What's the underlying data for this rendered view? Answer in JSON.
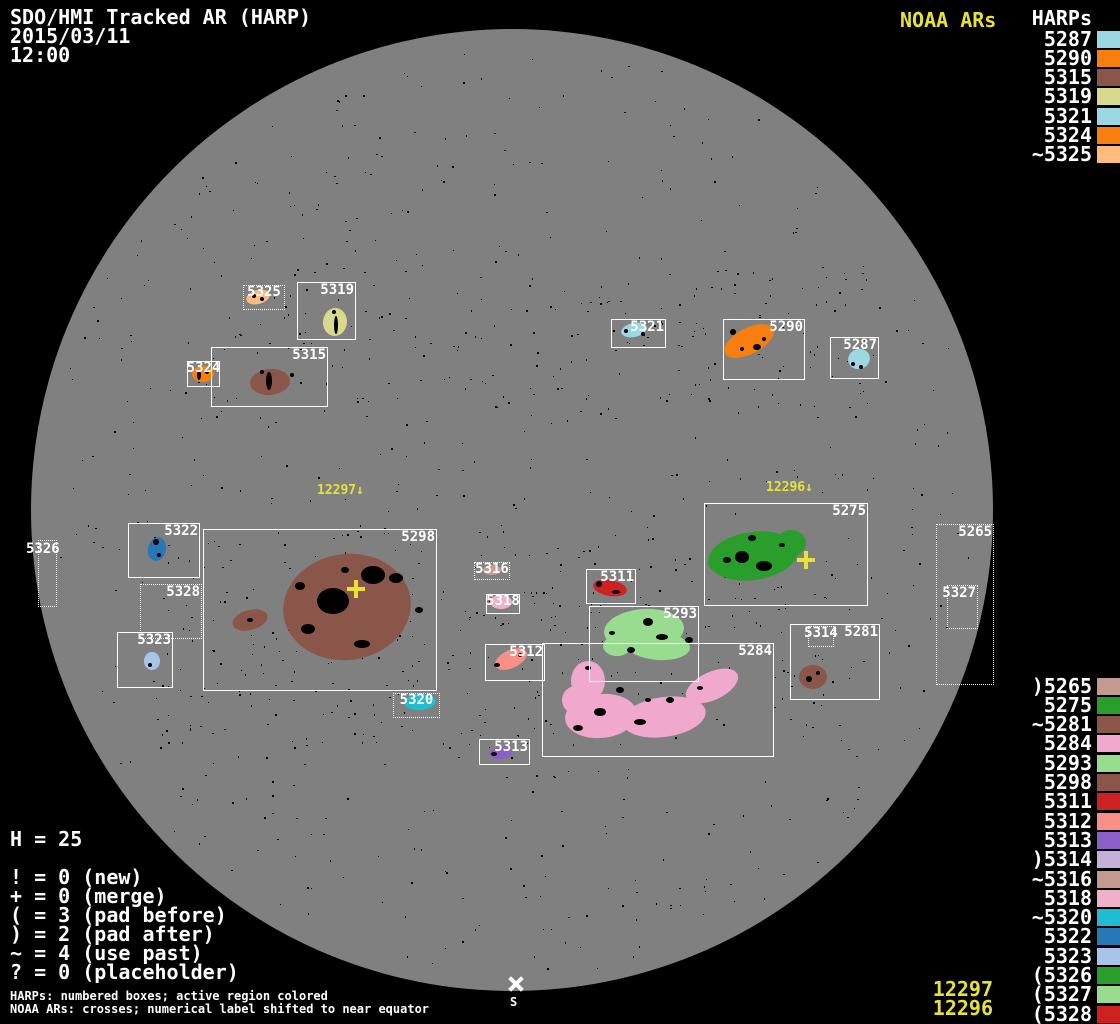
{
  "header": {
    "title": "SDO/HMI Tracked AR (HARP)",
    "date": "2015/03/11",
    "time": "12:00",
    "noaa_header": "NOAA ARs",
    "harps_header": "HARPs"
  },
  "colors": {
    "background": "#000000",
    "disk": "#808080",
    "box_border": "#ffffff",
    "label_white": "#ffffff",
    "noaa_yellow": "#e8e332",
    "speck": "#000000"
  },
  "disk": {
    "cx": 512,
    "cy": 510,
    "r": 481
  },
  "harp_list_top": [
    {
      "label": "5287",
      "color": "#9cd8e4"
    },
    {
      "label": "5290",
      "color": "#f87e10"
    },
    {
      "label": "5315",
      "color": "#8b564a"
    },
    {
      "label": "5319",
      "color": "#d8d88e"
    },
    {
      "label": "5321",
      "color": "#9cd8e4"
    },
    {
      "label": "5324",
      "color": "#f87e10"
    },
    {
      "label": "~5325",
      "color": "#ffbc7c"
    }
  ],
  "harp_list_bottom": [
    {
      "label": ")5265",
      "color": "#c49a90"
    },
    {
      "label": "5275",
      "color": "#2a9e2a"
    },
    {
      "label": "~5281",
      "color": "#8b564a"
    },
    {
      "label": "5284",
      "color": "#f0a8cc"
    },
    {
      "label": "5293",
      "color": "#98dc90"
    },
    {
      "label": "5298",
      "color": "#8b564a"
    },
    {
      "label": "5311",
      "color": "#cc2222"
    },
    {
      "label": "5312",
      "color": "#f89088"
    },
    {
      "label": "5313",
      "color": "#8a5fc8"
    },
    {
      "label": ")5314",
      "color": "#c4b0d8"
    },
    {
      "label": "~5316",
      "color": "#c49a90"
    },
    {
      "label": "5318",
      "color": "#f0b0c8"
    },
    {
      "label": "~5320",
      "color": "#20bcd0"
    },
    {
      "label": "5322",
      "color": "#2878b8"
    },
    {
      "label": "5323",
      "color": "#a8c4e8"
    },
    {
      "label": "(5326",
      "color": "#2a9e2a"
    },
    {
      "label": "(5327",
      "color": "#98dc90"
    },
    {
      "label": "(5328",
      "color": "#cc2222"
    }
  ],
  "noaa_bottom": [
    "12297",
    "12296"
  ],
  "legend": {
    "h_line": "H = 25",
    "lines": [
      "! = 0 (new)",
      "+ = 0 (merge)",
      "( = 3 (pad before)",
      ") = 2 (pad after)",
      "~ = 4 (use past)",
      "? = 0 (placeholder)"
    ]
  },
  "footnotes": [
    "HARPs: numbered boxes; active region colored",
    "NOAA ARs: crosses; numerical label shifted to near equator"
  ],
  "south_marker": {
    "label": "S",
    "x": 516,
    "y": 984
  },
  "noaa_crosses": [
    {
      "label": "12297↓",
      "lx": 317,
      "ly": 484,
      "cx": 356,
      "cy": 589
    },
    {
      "label": "12296↓",
      "lx": 766,
      "ly": 481,
      "cx": 806,
      "cy": 560
    }
  ],
  "regions": [
    {
      "label": "5325",
      "box": [
        243,
        285,
        40,
        23
      ],
      "border": "dotted",
      "label_pos": "c",
      "color": "#f8bc80",
      "blobs": [
        [
          258,
          297,
          12,
          7,
          -15
        ]
      ],
      "spots": [
        [
          254,
          296,
          2,
          2
        ],
        [
          262,
          299,
          2,
          2
        ]
      ]
    },
    {
      "label": "5319",
      "box": [
        297,
        282,
        57,
        56
      ],
      "border": "solid",
      "label_pos": "tr",
      "color": "#d8d88e",
      "blobs": [
        [
          335,
          322,
          12,
          14,
          5
        ]
      ],
      "spots": [
        [
          336,
          325,
          2,
          9
        ],
        [
          334,
          312,
          2,
          2
        ]
      ]
    },
    {
      "label": "5315",
      "box": [
        211,
        347,
        115,
        58
      ],
      "border": "solid",
      "label_pos": "tr",
      "color": "#8b564a",
      "blobs": [
        [
          270,
          382,
          20,
          13,
          -5
        ]
      ],
      "spots": [
        [
          269,
          381,
          3,
          9
        ],
        [
          262,
          372,
          2,
          2
        ],
        [
          292,
          375,
          2,
          2
        ]
      ]
    },
    {
      "label": "5324",
      "box": [
        187,
        361,
        31,
        24
      ],
      "border": "solid",
      "label_pos": "c",
      "color": "#f87e10",
      "blobs": [
        [
          203,
          374,
          11,
          8,
          0
        ]
      ],
      "spots": [
        [
          199,
          375,
          2,
          5
        ],
        [
          207,
          372,
          2,
          2
        ]
      ]
    },
    {
      "label": "5321",
      "box": [
        611,
        319,
        53,
        27
      ],
      "border": "solid",
      "label_pos": "tr",
      "color": "#9cd8e4",
      "blobs": [
        [
          634,
          330,
          13,
          7,
          -12
        ]
      ],
      "spots": [
        [
          626,
          331,
          2,
          2
        ],
        [
          643,
          334,
          2,
          2
        ]
      ]
    },
    {
      "label": "5290",
      "box": [
        723,
        319,
        80,
        59
      ],
      "border": "solid",
      "label_pos": "tr",
      "color": "#f87e10",
      "blobs": [
        [
          749,
          341,
          27,
          13,
          -27
        ]
      ],
      "spots": [
        [
          733,
          332,
          3,
          3
        ],
        [
          757,
          347,
          4,
          3
        ],
        [
          742,
          349,
          2,
          2
        ],
        [
          764,
          339,
          2,
          2
        ]
      ]
    },
    {
      "label": "5287",
      "box": [
        830,
        337,
        47,
        40
      ],
      "border": "solid",
      "label_pos": "tr",
      "color": "#9cd8e4",
      "blobs": [
        [
          859,
          359,
          11,
          10,
          -20
        ]
      ],
      "spots": [
        [
          853,
          364,
          2,
          2
        ],
        [
          861,
          367,
          2,
          2
        ]
      ]
    },
    {
      "label": "5322",
      "box": [
        128,
        523,
        70,
        53
      ],
      "border": "solid",
      "label_pos": "tr",
      "color": "#2878b8",
      "blobs": [
        [
          157,
          549,
          9,
          12,
          12
        ]
      ],
      "spots": [
        [
          156,
          542,
          3,
          3
        ],
        [
          159,
          555,
          2,
          2
        ]
      ]
    },
    {
      "label": "5326",
      "box": [
        38,
        540,
        17,
        65
      ],
      "border": "dotted",
      "label_pos": "tl-out",
      "color": null
    },
    {
      "label": "5328",
      "box": [
        140,
        584,
        60,
        53
      ],
      "border": "dotted",
      "label_pos": "tr",
      "color": null
    },
    {
      "label": "5323",
      "box": [
        117,
        632,
        54,
        54
      ],
      "border": "solid",
      "label_pos": "tr",
      "color": "#a8c4e8",
      "blobs": [
        [
          152,
          661,
          8,
          9,
          0
        ]
      ],
      "spots": [
        [
          150,
          665,
          2,
          2
        ]
      ]
    },
    {
      "label": "5298",
      "box": [
        203,
        529,
        232,
        160
      ],
      "border": "solid",
      "label_pos": "tr",
      "color": "#8b564a",
      "blobs": [
        [
          347,
          607,
          64,
          53,
          -8
        ],
        [
          250,
          620,
          18,
          10,
          -15
        ]
      ],
      "spots": [
        [
          333,
          601,
          16,
          13
        ],
        [
          373,
          575,
          12,
          9
        ],
        [
          308,
          629,
          7,
          5
        ],
        [
          396,
          578,
          7,
          5
        ],
        [
          362,
          644,
          8,
          4
        ],
        [
          300,
          586,
          5,
          4
        ],
        [
          419,
          610,
          4,
          3
        ],
        [
          345,
          570,
          4,
          3
        ],
        [
          250,
          620,
          3,
          2
        ]
      ]
    },
    {
      "label": "5316",
      "box": [
        474,
        562,
        34,
        16
      ],
      "border": "dotted",
      "label_pos": "c",
      "color": "#cc9c94",
      "blobs": [
        [
          492,
          570,
          9,
          5,
          0
        ]
      ],
      "spots": []
    },
    {
      "label": "5318",
      "box": [
        486,
        594,
        32,
        18
      ],
      "border": "solid",
      "label_pos": "c",
      "color": "#f0b0c8",
      "blobs": [
        [
          501,
          602,
          11,
          7,
          0
        ]
      ],
      "spots": []
    },
    {
      "label": "5311",
      "box": [
        586,
        569,
        48,
        33
      ],
      "border": "solid",
      "label_pos": "tr",
      "color": "#cc2222",
      "blobs": [
        [
          610,
          588,
          17,
          8,
          10
        ]
      ],
      "spots": [
        [
          599,
          584,
          3,
          3
        ],
        [
          616,
          592,
          4,
          2
        ]
      ]
    },
    {
      "label": "5293",
      "box": [
        589,
        606,
        108,
        74
      ],
      "border": "solid",
      "label_pos": "tr",
      "color": "#98dc90",
      "blobs": [
        [
          644,
          630,
          40,
          21,
          -4
        ],
        [
          658,
          646,
          32,
          14,
          4
        ],
        [
          617,
          646,
          14,
          10,
          0
        ]
      ],
      "spots": [
        [
          648,
          622,
          5,
          4
        ],
        [
          662,
          637,
          6,
          3
        ],
        [
          631,
          650,
          4,
          3
        ],
        [
          689,
          640,
          4,
          3
        ],
        [
          612,
          633,
          3,
          2
        ]
      ]
    },
    {
      "label": "5275",
      "box": [
        704,
        503,
        162,
        101
      ],
      "border": "solid",
      "label_pos": "tr",
      "color": "#2a9e2a",
      "blobs": [
        [
          753,
          556,
          45,
          24,
          -8
        ],
        [
          791,
          543,
          15,
          13,
          0
        ],
        [
          722,
          563,
          14,
          10,
          0
        ]
      ],
      "spots": [
        [
          742,
          557,
          7,
          6
        ],
        [
          764,
          566,
          8,
          5
        ],
        [
          727,
          560,
          4,
          3
        ],
        [
          752,
          538,
          4,
          3
        ],
        [
          782,
          545,
          3,
          2
        ]
      ]
    },
    {
      "label": "5265",
      "box": [
        936,
        524,
        56,
        159
      ],
      "border": "dotted",
      "label_pos": "tr",
      "color": null
    },
    {
      "label": "5327",
      "box": [
        947,
        585,
        29,
        42
      ],
      "border": "dotted",
      "label_pos": "tr",
      "color": null
    },
    {
      "label": "5281",
      "box": [
        790,
        624,
        88,
        74
      ],
      "border": "solid",
      "label_pos": "tr",
      "color": "#8b564a",
      "blobs": [
        [
          813,
          677,
          14,
          12,
          0
        ]
      ],
      "spots": [
        [
          809,
          679,
          3,
          3
        ],
        [
          818,
          673,
          2,
          2
        ]
      ]
    },
    {
      "label": "5314",
      "box": [
        808,
        626,
        24,
        19
      ],
      "border": "dotted",
      "label_pos": "c",
      "color": null
    },
    {
      "label": "5284",
      "box": [
        542,
        643,
        230,
        112
      ],
      "border": "solid",
      "label_pos": "tr",
      "color": "#f0a8cc",
      "blobs": [
        [
          588,
          681,
          17,
          20,
          0
        ],
        [
          601,
          716,
          36,
          22,
          -5
        ],
        [
          664,
          717,
          42,
          20,
          -8
        ],
        [
          712,
          686,
          28,
          14,
          -25
        ],
        [
          576,
          700,
          14,
          14,
          0
        ]
      ],
      "spots": [
        [
          600,
          712,
          6,
          4
        ],
        [
          640,
          722,
          6,
          3
        ],
        [
          578,
          728,
          5,
          3
        ],
        [
          670,
          700,
          4,
          3
        ],
        [
          700,
          688,
          3,
          2
        ],
        [
          620,
          690,
          4,
          3
        ],
        [
          588,
          668,
          3,
          2
        ],
        [
          648,
          700,
          3,
          2
        ]
      ]
    },
    {
      "label": "5313",
      "box": [
        479,
        739,
        49,
        24
      ],
      "border": "solid",
      "label_pos": "tr",
      "color": "#8a5fc8",
      "blobs": [
        [
          501,
          753,
          12,
          6,
          -8
        ]
      ],
      "spots": [
        [
          494,
          754,
          3,
          2
        ]
      ]
    },
    {
      "label": "5320",
      "box": [
        393,
        693,
        45,
        23
      ],
      "border": "dotted",
      "label_pos": "c",
      "color": "#20bcd0",
      "blobs": [
        [
          420,
          702,
          16,
          8,
          -4
        ]
      ],
      "spots": []
    },
    {
      "label": "5312",
      "box": [
        485,
        644,
        58,
        35
      ],
      "border": "solid",
      "label_pos": "tr",
      "color": "#f89088",
      "blobs": [
        [
          511,
          659,
          17,
          9,
          -25
        ]
      ],
      "spots": [
        [
          497,
          665,
          3,
          2
        ],
        [
          520,
          655,
          2,
          2
        ]
      ]
    }
  ]
}
